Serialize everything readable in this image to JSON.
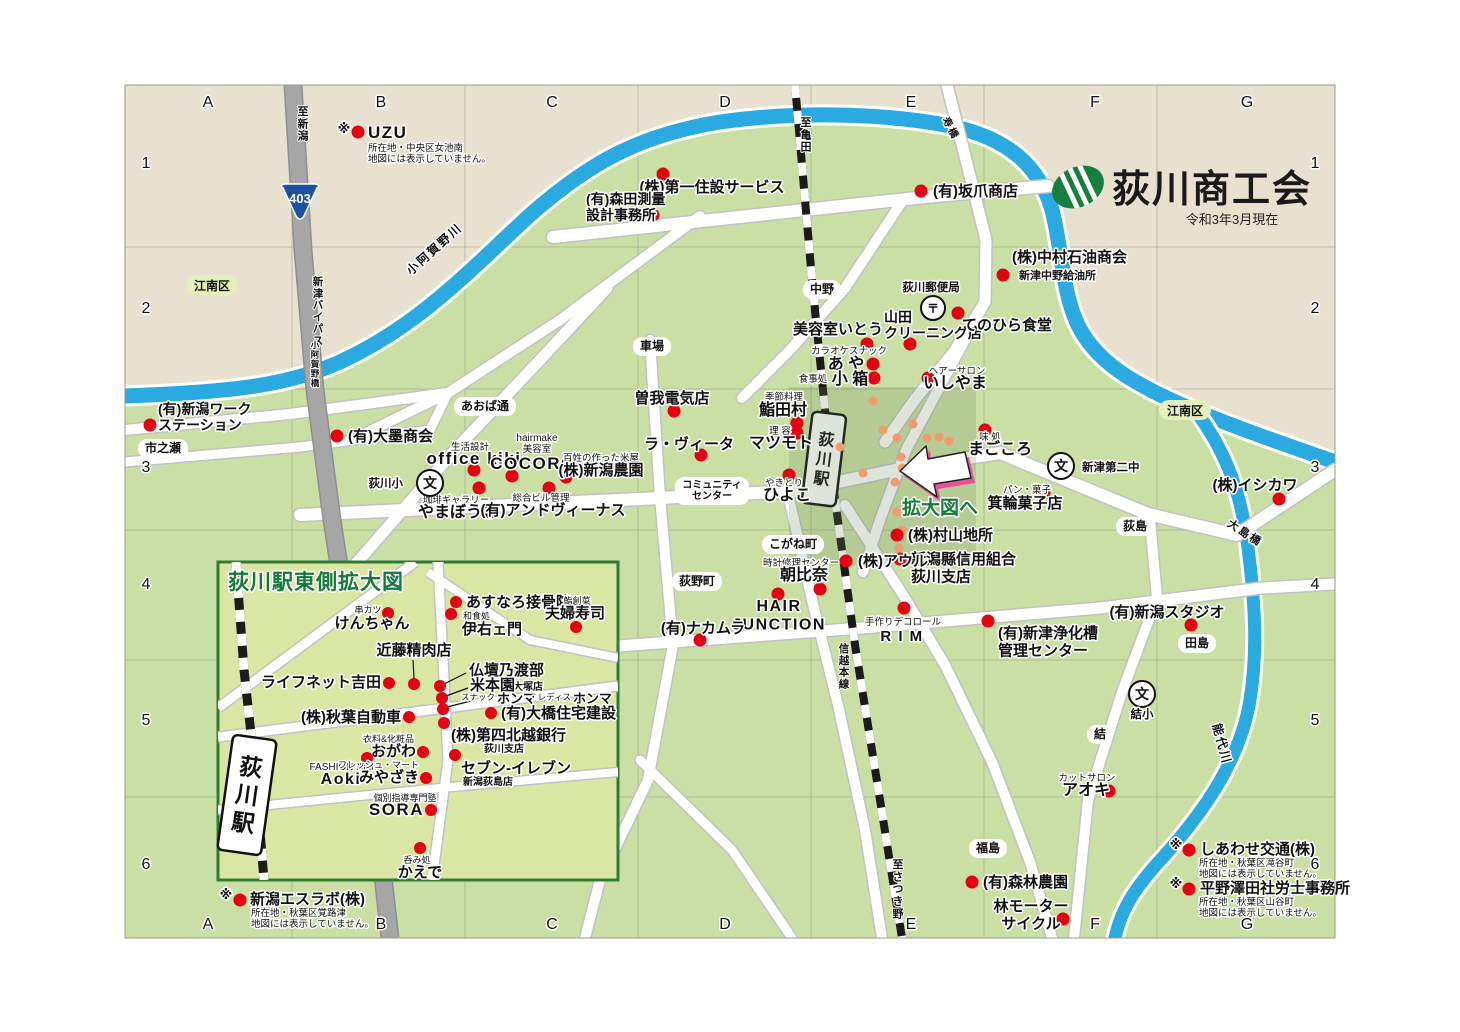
{
  "title": {
    "org": "荻川商工会",
    "as_of": "令和3年3月現在"
  },
  "colors": {
    "beige": "#e8e1d0",
    "green": "#c9dfa4",
    "inset_green": "#dae6a3",
    "river": "#2ba9e1",
    "road_white": "#ffffff",
    "road_casing": "#c2c2c2",
    "bypass": "#a6a6a6",
    "rail": "#1b1b1b",
    "red_dot": "#e60012",
    "orange_dot": "#f29a70",
    "district_green": "#e4f0bc",
    "dark_green": "#157a38",
    "accent_pink": "#f0439b",
    "shield_blue": "#1d50a2",
    "grid_line": "#98a088",
    "logo_green": "#15803d"
  },
  "grid": {
    "letters": [
      "A",
      "B",
      "C",
      "D",
      "E",
      "F",
      "G"
    ],
    "letters_x": [
      208,
      381,
      552,
      725,
      911,
      1095,
      1247
    ],
    "top_y": 107,
    "bottom_y": 929,
    "numbers": [
      "1",
      "2",
      "3",
      "4",
      "5",
      "6"
    ],
    "numbers_y": [
      168,
      313,
      472,
      589,
      725,
      869
    ],
    "left_x": 146,
    "right_x": 1315
  },
  "pills": [
    {
      "t": "中野",
      "x": 822,
      "y": 293
    },
    {
      "t": "車場",
      "x": 652,
      "y": 350
    },
    {
      "t": "市之瀬",
      "x": 163,
      "y": 452
    },
    {
      "t": "あおば通",
      "x": 485,
      "y": 410
    },
    {
      "t": "こがね町",
      "x": 793,
      "y": 548
    },
    {
      "t": "荻野町",
      "x": 697,
      "y": 585
    },
    {
      "t": "荻島",
      "x": 1135,
      "y": 530
    },
    {
      "t": "田島",
      "x": 1197,
      "y": 647
    },
    {
      "t": "結",
      "x": 1100,
      "y": 738
    },
    {
      "t": "福島",
      "x": 988,
      "y": 852
    },
    {
      "t": "コミュニティ\nセンター",
      "x": 712,
      "y": 491,
      "fs": 10
    }
  ],
  "districts": [
    {
      "t": "江南区",
      "x": 212,
      "y": 288
    },
    {
      "t": "江南区",
      "x": 1185,
      "y": 413
    }
  ],
  "schools": [
    {
      "t": "荻川小",
      "x": 430,
      "y": 483,
      "lx": 403,
      "ly": 487,
      "la": "e"
    },
    {
      "t": "新津第二中",
      "x": 1061,
      "y": 466,
      "lx": 1082,
      "ly": 471,
      "la": "s"
    },
    {
      "t": "結小",
      "x": 1142,
      "y": 694,
      "lx": 1142,
      "ly": 718,
      "la": "m"
    }
  ],
  "post_office": {
    "t": "〒",
    "label": "荻川郵便局",
    "x": 933,
    "y": 308,
    "lx": 931,
    "ly": 291
  },
  "shield": {
    "t": "403",
    "x": 300,
    "y": 202
  },
  "route_labels": {
    "vert": [
      {
        "t": "至新潟",
        "x": 303,
        "y": 115,
        "fs": 11
      },
      {
        "t": "新津バイパス",
        "x": 318,
        "y": 285,
        "fs": 10.5
      },
      {
        "t": "至亀田",
        "x": 806,
        "y": 126,
        "fs": 11
      },
      {
        "t": "至さつき野",
        "x": 898,
        "y": 868,
        "fs": 11
      },
      {
        "t": "信越本線",
        "x": 844,
        "y": 652,
        "fs": 10.5
      },
      {
        "t": "小阿賀野橋",
        "x": 315,
        "y": 348,
        "fs": 8.5
      }
    ],
    "rot": [
      {
        "t": "小阿賀野川",
        "x": 437,
        "y": 252,
        "r": -42,
        "fs": 12
      },
      {
        "t": "能代川",
        "x": 1218,
        "y": 745,
        "r": 75,
        "fs": 12
      },
      {
        "t": "大島橋",
        "x": 1243,
        "y": 536,
        "r": 33,
        "fs": 11
      },
      {
        "t": "寿橋",
        "x": 948,
        "y": 130,
        "r": 62,
        "fs": 10
      }
    ]
  },
  "stations": {
    "main": {
      "t": "荻川駅",
      "x": 824,
      "y": 459,
      "rot": 7,
      "w": 34,
      "h": 92,
      "fs": 16
    },
    "inset": {
      "t": "荻川駅",
      "x": 247,
      "y": 795,
      "rot": 8,
      "w": 44,
      "h": 116,
      "fs": 23
    }
  },
  "businesses": [
    {
      "n": "(株)第一住設サービス",
      "x": 712,
      "y": 192,
      "d": [
        [
          663,
          174
        ]
      ]
    },
    {
      "n": "(有)森田測量\n設計事務所",
      "a": "s",
      "x": 586,
      "y": 204,
      "fs": 14,
      "d": [
        [
          653,
          215
        ]
      ]
    },
    {
      "n": "(有)坂爪商店",
      "a": "s",
      "x": 933,
      "y": 196,
      "d": [
        [
          921,
          191
        ]
      ]
    },
    {
      "n": "(株)中村石油商会",
      "a": "s",
      "x": 1012,
      "y": 262,
      "sm": [
        {
          "t": "新津中野給油所",
          "x": 1019,
          "y": 279,
          "fs": 11,
          "b": 1,
          "a": "s"
        }
      ],
      "d": [
        [
          1003,
          275
        ]
      ]
    },
    {
      "n": "美容室いとう",
      "x": 838,
      "y": 334,
      "d": [
        [
          867,
          344
        ]
      ]
    },
    {
      "n": "山田\nクリーニング店",
      "a": "s",
      "x": 884,
      "y": 322,
      "fs": 14,
      "d": [
        [
          910,
          344
        ]
      ]
    },
    {
      "n": "てのひら食堂",
      "x": 1007,
      "y": 330,
      "d": [
        [
          958,
          313
        ]
      ]
    },
    {
      "n": "あ や",
      "x": 846,
      "y": 369,
      "fs": 16,
      "sm": [
        {
          "t": "カラオケスナック",
          "x": 849,
          "y": 354,
          "fs": 9.5
        }
      ],
      "d": [
        [
          873,
          364
        ]
      ]
    },
    {
      "n": "小 箱",
      "x": 850,
      "y": 384,
      "fs": 16,
      "sm": [
        {
          "t": "食事処",
          "x": 813,
          "y": 382,
          "fs": 9.5
        }
      ],
      "d": [
        [
          874,
          378
        ]
      ]
    },
    {
      "n": "いしやま",
      "x": 955,
      "y": 388,
      "fs": 16,
      "sm": [
        {
          "t": "ヘアーサロン",
          "x": 957,
          "y": 374,
          "fs": 9.5
        }
      ],
      "d": [
        [
          928,
          378
        ]
      ]
    },
    {
      "n": "(有)新潟ワーク\nステーション",
      "a": "s",
      "x": 158,
      "y": 414,
      "fs": 14,
      "d": [
        [
          150,
          425
        ]
      ]
    },
    {
      "n": "(有)大墨商会",
      "a": "s",
      "x": 348,
      "y": 441,
      "d": [
        [
          337,
          436
        ]
      ]
    },
    {
      "n": "office kiki",
      "x": 474,
      "y": 464,
      "fs": 17,
      "lat": 1,
      "sm": [
        {
          "t": "生活設計",
          "x": 470,
          "y": 450,
          "fs": 9.5
        }
      ],
      "d": [
        [
          474,
          470
        ]
      ]
    },
    {
      "n": "COCORO",
      "x": 533,
      "y": 469,
      "fs": 17,
      "lat": 1,
      "sm": [
        {
          "t": "hairmake",
          "x": 537,
          "y": 441,
          "fs": 10
        },
        {
          "t": "美容室",
          "x": 537,
          "y": 452,
          "fs": 9.5
        }
      ],
      "d": [
        [
          512,
          476
        ]
      ]
    },
    {
      "n": "(株)新潟農園",
      "x": 601,
      "y": 475,
      "sm": [
        {
          "t": "百姓の作った米屋",
          "x": 601,
          "y": 461,
          "fs": 9.5
        }
      ],
      "d": [
        [
          566,
          477
        ]
      ]
    },
    {
      "n": "やまぼうし",
      "x": 458,
      "y": 517,
      "fs": 16,
      "sm": [
        {
          "t": "珈琲ギャラリー",
          "x": 456,
          "y": 503,
          "fs": 9.5
        }
      ],
      "d": [
        [
          479,
          488
        ]
      ]
    },
    {
      "n": "(有)アンドヴィーナス",
      "x": 553,
      "y": 515,
      "sm": [
        {
          "t": "総合ビル管理",
          "x": 541,
          "y": 501,
          "fs": 9.5
        }
      ],
      "d": [
        [
          549,
          488
        ]
      ]
    },
    {
      "n": "曽我電気店",
      "x": 672,
      "y": 403,
      "d": [
        [
          674,
          411
        ]
      ]
    },
    {
      "n": "ラ・ヴィータ",
      "x": 689,
      "y": 449,
      "d": [
        [
          701,
          455
        ]
      ]
    },
    {
      "n": "鮨田村",
      "x": 783,
      "y": 415,
      "fs": 16,
      "sm": [
        {
          "t": "季節料理",
          "x": 784,
          "y": 400,
          "fs": 9.5
        }
      ],
      "d": [
        [
          797,
          423
        ]
      ]
    },
    {
      "n": "マツモト",
      "x": 781,
      "y": 448,
      "fs": 16,
      "sm": [
        {
          "t": "理 容",
          "x": 780,
          "y": 434,
          "fs": 9.5
        }
      ],
      "d": [
        [
          797,
          433
        ]
      ]
    },
    {
      "n": "ひよこ",
      "x": 787,
      "y": 500,
      "fs": 16,
      "sm": [
        {
          "t": "やきとり",
          "x": 784,
          "y": 486,
          "fs": 9.5
        }
      ],
      "d": [
        [
          789,
          475
        ]
      ]
    },
    {
      "n": "まごころ",
      "x": 1000,
      "y": 454,
      "fs": 16,
      "sm": [
        {
          "t": "味 処",
          "x": 990,
          "y": 440,
          "fs": 9.5
        }
      ],
      "d": [
        [
          985,
          430
        ]
      ]
    },
    {
      "n": "箕輪菓子店",
      "x": 1025,
      "y": 508,
      "sm": [
        {
          "t": "パン・菓子",
          "x": 1027,
          "y": 493,
          "fs": 9.5
        }
      ],
      "d": [
        [
          1044,
          493
        ]
      ]
    },
    {
      "n": "(株)村山地所",
      "a": "s",
      "x": 908,
      "y": 540,
      "d": [
        [
          897,
          535
        ]
      ]
    },
    {
      "n": "新潟縣信用組合\n荻川支店",
      "a": "s",
      "x": 911,
      "y": 564,
      "d": [
        [
          900,
          559
        ]
      ]
    },
    {
      "n": "(株)アウル",
      "a": "s",
      "x": 858,
      "y": 566,
      "d": [
        [
          846,
          561
        ]
      ]
    },
    {
      "n": "朝比奈",
      "x": 804,
      "y": 580,
      "fs": 16,
      "sm": [
        {
          "t": "時計修理センター",
          "x": 801,
          "y": 566,
          "fs": 9.5
        }
      ],
      "d": [
        [
          820,
          589
        ]
      ]
    },
    {
      "n": "HAIR\nJUNCTION",
      "x": 779,
      "y": 611,
      "fs": 16,
      "lat": 1,
      "d": [
        [
          778,
          594
        ]
      ]
    },
    {
      "n": "(有)ナカムラ",
      "x": 703,
      "y": 633,
      "d": [
        [
          700,
          640
        ]
      ]
    },
    {
      "n": "R I M",
      "x": 902,
      "y": 641,
      "lat": 1,
      "sm": [
        {
          "t": "手作りデコロール",
          "x": 903,
          "y": 625,
          "fs": 9.5
        }
      ],
      "d": [
        [
          904,
          608
        ]
      ]
    },
    {
      "n": "(有)新津浄化槽\n管理センター",
      "a": "s",
      "x": 998,
      "y": 638,
      "d": [
        [
          988,
          621
        ]
      ]
    },
    {
      "n": "(有)新潟スタジオ",
      "x": 1167,
      "y": 617,
      "d": [
        [
          1191,
          625
        ]
      ]
    },
    {
      "n": "(株)イシカワ",
      "x": 1255,
      "y": 490,
      "d": [
        [
          1279,
          499
        ]
      ]
    },
    {
      "n": "アオキ",
      "x": 1086,
      "y": 795,
      "fs": 16,
      "sm": [
        {
          "t": "カットサロン",
          "x": 1087,
          "y": 781,
          "fs": 9.5
        }
      ],
      "d": [
        [
          1109,
          791
        ]
      ]
    },
    {
      "n": "(有)森林農園",
      "a": "s",
      "x": 983,
      "y": 887,
      "d": [
        [
          972,
          882
        ]
      ]
    },
    {
      "n": "林モーター\nサイクル",
      "x": 1031,
      "y": 911,
      "d": [
        [
          1063,
          919
        ]
      ]
    }
  ],
  "inset": {
    "title": "荻川駅東側拡大図",
    "businesses": [
      {
        "n": "けんちゃん",
        "x": 372,
        "y": 628,
        "fs": 15,
        "sm": [
          {
            "t": "串カツ",
            "x": 368,
            "y": 613,
            "fs": 9
          }
        ],
        "d": [
          [
            388,
            613
          ]
        ]
      },
      {
        "n": "あすなろ接骨院",
        "a": "s",
        "x": 466,
        "y": 607,
        "fs": 15,
        "d": [
          [
            456,
            602
          ]
        ]
      },
      {
        "n": "伊右ェ門",
        "a": "s",
        "x": 462,
        "y": 634,
        "fs": 15,
        "sm": [
          {
            "t": "和食処",
            "x": 463,
            "y": 619,
            "fs": 9,
            "a": "s"
          }
        ],
        "d": [
          [
            451,
            614
          ]
        ]
      },
      {
        "n": "夫婦寿司",
        "x": 575,
        "y": 618,
        "fs": 15,
        "sm": [
          {
            "t": "鮨創菜",
            "x": 577,
            "y": 604,
            "fs": 9
          }
        ],
        "d": [
          [
            576,
            627
          ]
        ]
      },
      {
        "n": "近藤精肉店",
        "x": 414,
        "y": 655,
        "d": [
          [
            414,
            684
          ]
        ],
        "ld": [
          [
            413,
            660
          ],
          [
            414,
            678
          ]
        ]
      },
      {
        "n": "ライフネット吉田",
        "a": "e",
        "x": 381,
        "y": 687,
        "d": [
          [
            389,
            683
          ]
        ]
      },
      {
        "n": "仏壇乃渡部",
        "a": "s",
        "x": 469,
        "y": 675,
        "d": [
          [
            440,
            686
          ]
        ],
        "ld": [
          [
            466,
            673
          ],
          [
            444,
            684
          ]
        ]
      },
      {
        "n": "米本園",
        "a": "s",
        "x": 470,
        "y": 690,
        "sm": [
          {
            "t": "大塚店",
            "x": 513,
            "y": 690,
            "fs": 10,
            "b": 1,
            "a": "s"
          }
        ],
        "d": [
          [
            442,
            698
          ]
        ],
        "ld": [
          [
            468,
            688
          ],
          [
            446,
            696
          ]
        ]
      },
      {
        "n": "ホンマ",
        "a": "s",
        "x": 497,
        "y": 703,
        "fs": 13,
        "sm": [
          {
            "t": "スナック",
            "x": 495,
            "y": 700,
            "fs": 8.5,
            "a": "e"
          }
        ],
        "d": [
          [
            443,
            709
          ]
        ],
        "ld": [
          [
            471,
            701
          ],
          [
            447,
            707
          ]
        ]
      },
      {
        "n": "ホンマ",
        "a": "s",
        "x": 573,
        "y": 703,
        "fs": 13,
        "sm": [
          {
            "t": "・レディス",
            "x": 571,
            "y": 700,
            "fs": 8.5,
            "a": "e"
          }
        ]
      },
      {
        "n": "(有)大橋住宅建設",
        "a": "s",
        "x": 501,
        "y": 718,
        "d": [
          [
            491,
            713
          ]
        ]
      },
      {
        "n": "(株)秋葉自動車",
        "a": "e",
        "x": 401,
        "y": 722,
        "d": [
          [
            409,
            717
          ]
        ]
      },
      {
        "n": "(株)第四北越銀行",
        "a": "s",
        "x": 451,
        "y": 740,
        "sm": [
          {
            "t": "荻川支店",
            "x": 484,
            "y": 752,
            "fs": 10,
            "b": 1,
            "a": "s"
          }
        ],
        "d": [
          [
            444,
            723
          ]
        ]
      },
      {
        "n": "おがわ",
        "a": "e",
        "x": 416,
        "y": 756,
        "fs": 15,
        "sm": [
          {
            "t": "衣料&化粧品",
            "x": 414,
            "y": 742,
            "fs": 9,
            "a": "e"
          }
        ],
        "d": [
          [
            423,
            752
          ]
        ]
      },
      {
        "n": "Aoki",
        "x": 341,
        "y": 784,
        "fs": 16,
        "lat": 1,
        "sm": [
          {
            "t": "FASHION Hair",
            "x": 342,
            "y": 770,
            "fs": 10
          }
        ],
        "d": [
          [
            367,
            758
          ]
        ]
      },
      {
        "n": "みやざき",
        "a": "e",
        "x": 419,
        "y": 782,
        "fs": 15,
        "sm": [
          {
            "t": "フレッシュ・マート",
            "x": 419,
            "y": 768,
            "fs": 9,
            "a": "e"
          }
        ],
        "d": [
          [
            426,
            778
          ]
        ]
      },
      {
        "n": "セブン-イレブン",
        "a": "s",
        "x": 461,
        "y": 773,
        "fs": 15,
        "sm": [
          {
            "t": "新潟荻島店",
            "x": 488,
            "y": 785,
            "fs": 10,
            "b": 1
          }
        ],
        "d": [
          [
            455,
            755
          ]
        ]
      },
      {
        "n": "SORA",
        "a": "e",
        "x": 424,
        "y": 815,
        "fs": 17,
        "lat": 1,
        "sm": [
          {
            "t": "個別指導専門塾",
            "x": 405,
            "y": 801,
            "fs": 9
          }
        ],
        "d": [
          [
            431,
            810
          ]
        ]
      },
      {
        "n": "かえで",
        "x": 420,
        "y": 877,
        "fs": 15,
        "sm": [
          {
            "t": "呑み処",
            "x": 417,
            "y": 863,
            "fs": 9
          }
        ],
        "d": [
          [
            420,
            848
          ]
        ]
      }
    ]
  },
  "notes": [
    {
      "name": "UZU",
      "fs": 17,
      "lat": 1,
      "sym": [
        344,
        133
      ],
      "dot": [
        358,
        132
      ],
      "x": 368,
      "y": 138,
      "notes": [
        "所在地・中央区女池南",
        "地図には表示していません。"
      ],
      "nx": 368,
      "ny": 151
    },
    {
      "name": "新潟エスラボ(株)",
      "fs": 15,
      "sym": [
        226,
        899
      ],
      "dot": [
        240,
        900
      ],
      "x": 250,
      "y": 904,
      "notes": [
        "所在地・秋葉区覚路津",
        "地図には表示していません。"
      ],
      "nx": 251,
      "ny": 916
    },
    {
      "name": "しあわせ交通(株)",
      "fs": 15,
      "sym": [
        1176,
        849
      ],
      "dot": [
        1189,
        850
      ],
      "x": 1200,
      "y": 854,
      "notes": [
        "所在地・秋葉区滝谷町",
        "地図には表示していません。"
      ],
      "nx": 1199,
      "ny": 866
    },
    {
      "name": "平野澤田社労士事務所",
      "fs": 15,
      "sym": [
        1176,
        888
      ],
      "dot": [
        1189,
        889
      ],
      "x": 1200,
      "y": 893,
      "notes": [
        "所在地・秋葉区山谷町",
        "地図には表示していません。"
      ],
      "nx": 1199,
      "ny": 905
    }
  ],
  "enlarge": {
    "label": "拡大図へ"
  },
  "overlay": {
    "box": {
      "x": 789,
      "y": 387,
      "w": 187,
      "h": 178
    },
    "dots": [
      [
        873,
        401
      ],
      [
        840,
        447
      ],
      [
        883,
        430
      ],
      [
        913,
        424
      ],
      [
        897,
        438
      ],
      [
        927,
        438
      ],
      [
        939,
        437
      ],
      [
        949,
        441
      ],
      [
        901,
        457
      ],
      [
        902,
        468
      ],
      [
        863,
        473
      ],
      [
        895,
        482
      ],
      [
        925,
        452
      ],
      [
        897,
        512
      ],
      [
        902,
        530
      ],
      [
        899,
        548
      ]
    ]
  }
}
